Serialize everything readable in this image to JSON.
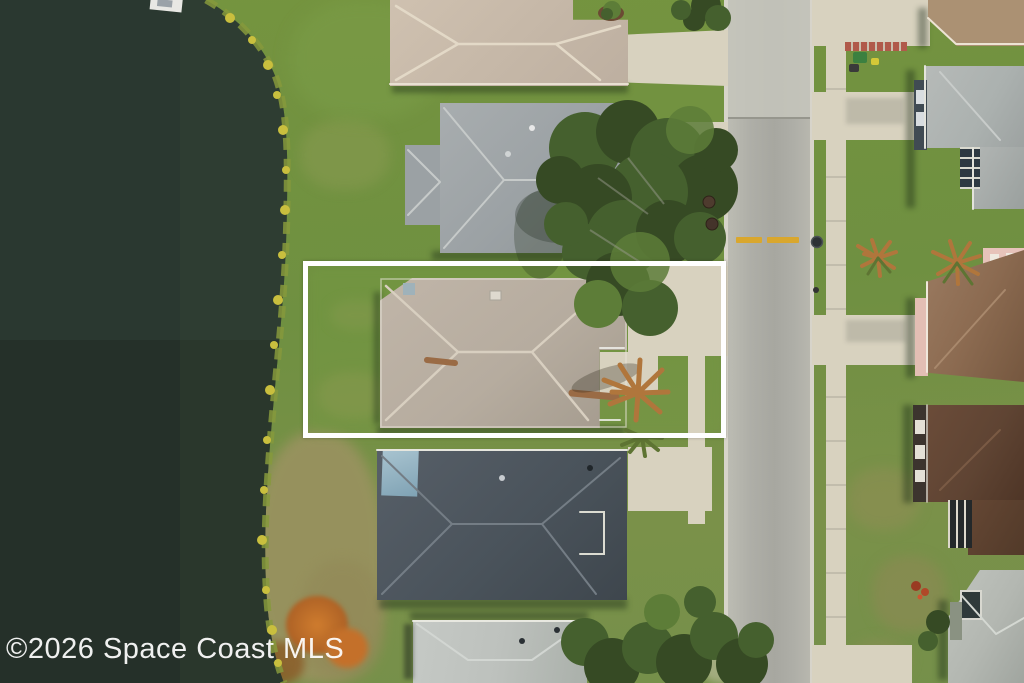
{
  "title": "Aerial property photo",
  "watermark": {
    "text": "©2026 Space Coast MLS",
    "color": "#ffffff"
  },
  "highlight": {
    "label": "subject-property-boundary",
    "style": "left:303px;top:261px;width:423px;height:177px",
    "border_color": "#ffffff",
    "border_px": 5
  },
  "colors": {
    "water": "#2a3830",
    "water_deep": "#1e2822",
    "shore": "#86993c",
    "bloom": "#c9bf3e",
    "grass": "#75943f",
    "grass_dry": "#99925f",
    "street": "#aeaea7",
    "street_new": "#c6c5bc",
    "curb": "#d7d4ca",
    "lane": "#d9a72e",
    "concrete": "#d8d2bf",
    "roof_a": "#cfc1b0",
    "roof_b": "#9ba1a4",
    "roof_c": "#b6ac9f",
    "roof_d": "#4a535b",
    "roof_e": "#bdc1bd",
    "roof_f": "#ab9173",
    "roof_g": "#abb1af",
    "roof_h": "#8c6b51",
    "roof_i": "#5f4433",
    "roof_j": "#b3b7b1",
    "wall_dark": "#404b53",
    "pink": "#e7c3ba",
    "tree": "#45602e",
    "tree_dark": "#364a24",
    "tree_light": "#5d7d38",
    "palm": "#b0763c",
    "palm_green": "#5e7433",
    "bush": "#c4702a",
    "white": "#ffffff"
  },
  "scene": {
    "description": "Overhead drone view of a residential neighborhood: dark lake at left with yellow-flowered shoreline, a column of single-story homes between the lake and a vertical street, a sidewalk and second row of homes on the right; the subject lot with tan hip roof, palm tree and driveway is outlined by a white rectangle.",
    "features": [
      "lake",
      "shoreline-vegetation",
      "dock",
      "subject-lot-outline",
      "subject-house",
      "neighbor-houses",
      "street-with-yellow-lane-dashes",
      "sidewalk",
      "driveways",
      "tree-canopy",
      "palm-trees",
      "orange-shrub",
      "trash-bins"
    ]
  }
}
